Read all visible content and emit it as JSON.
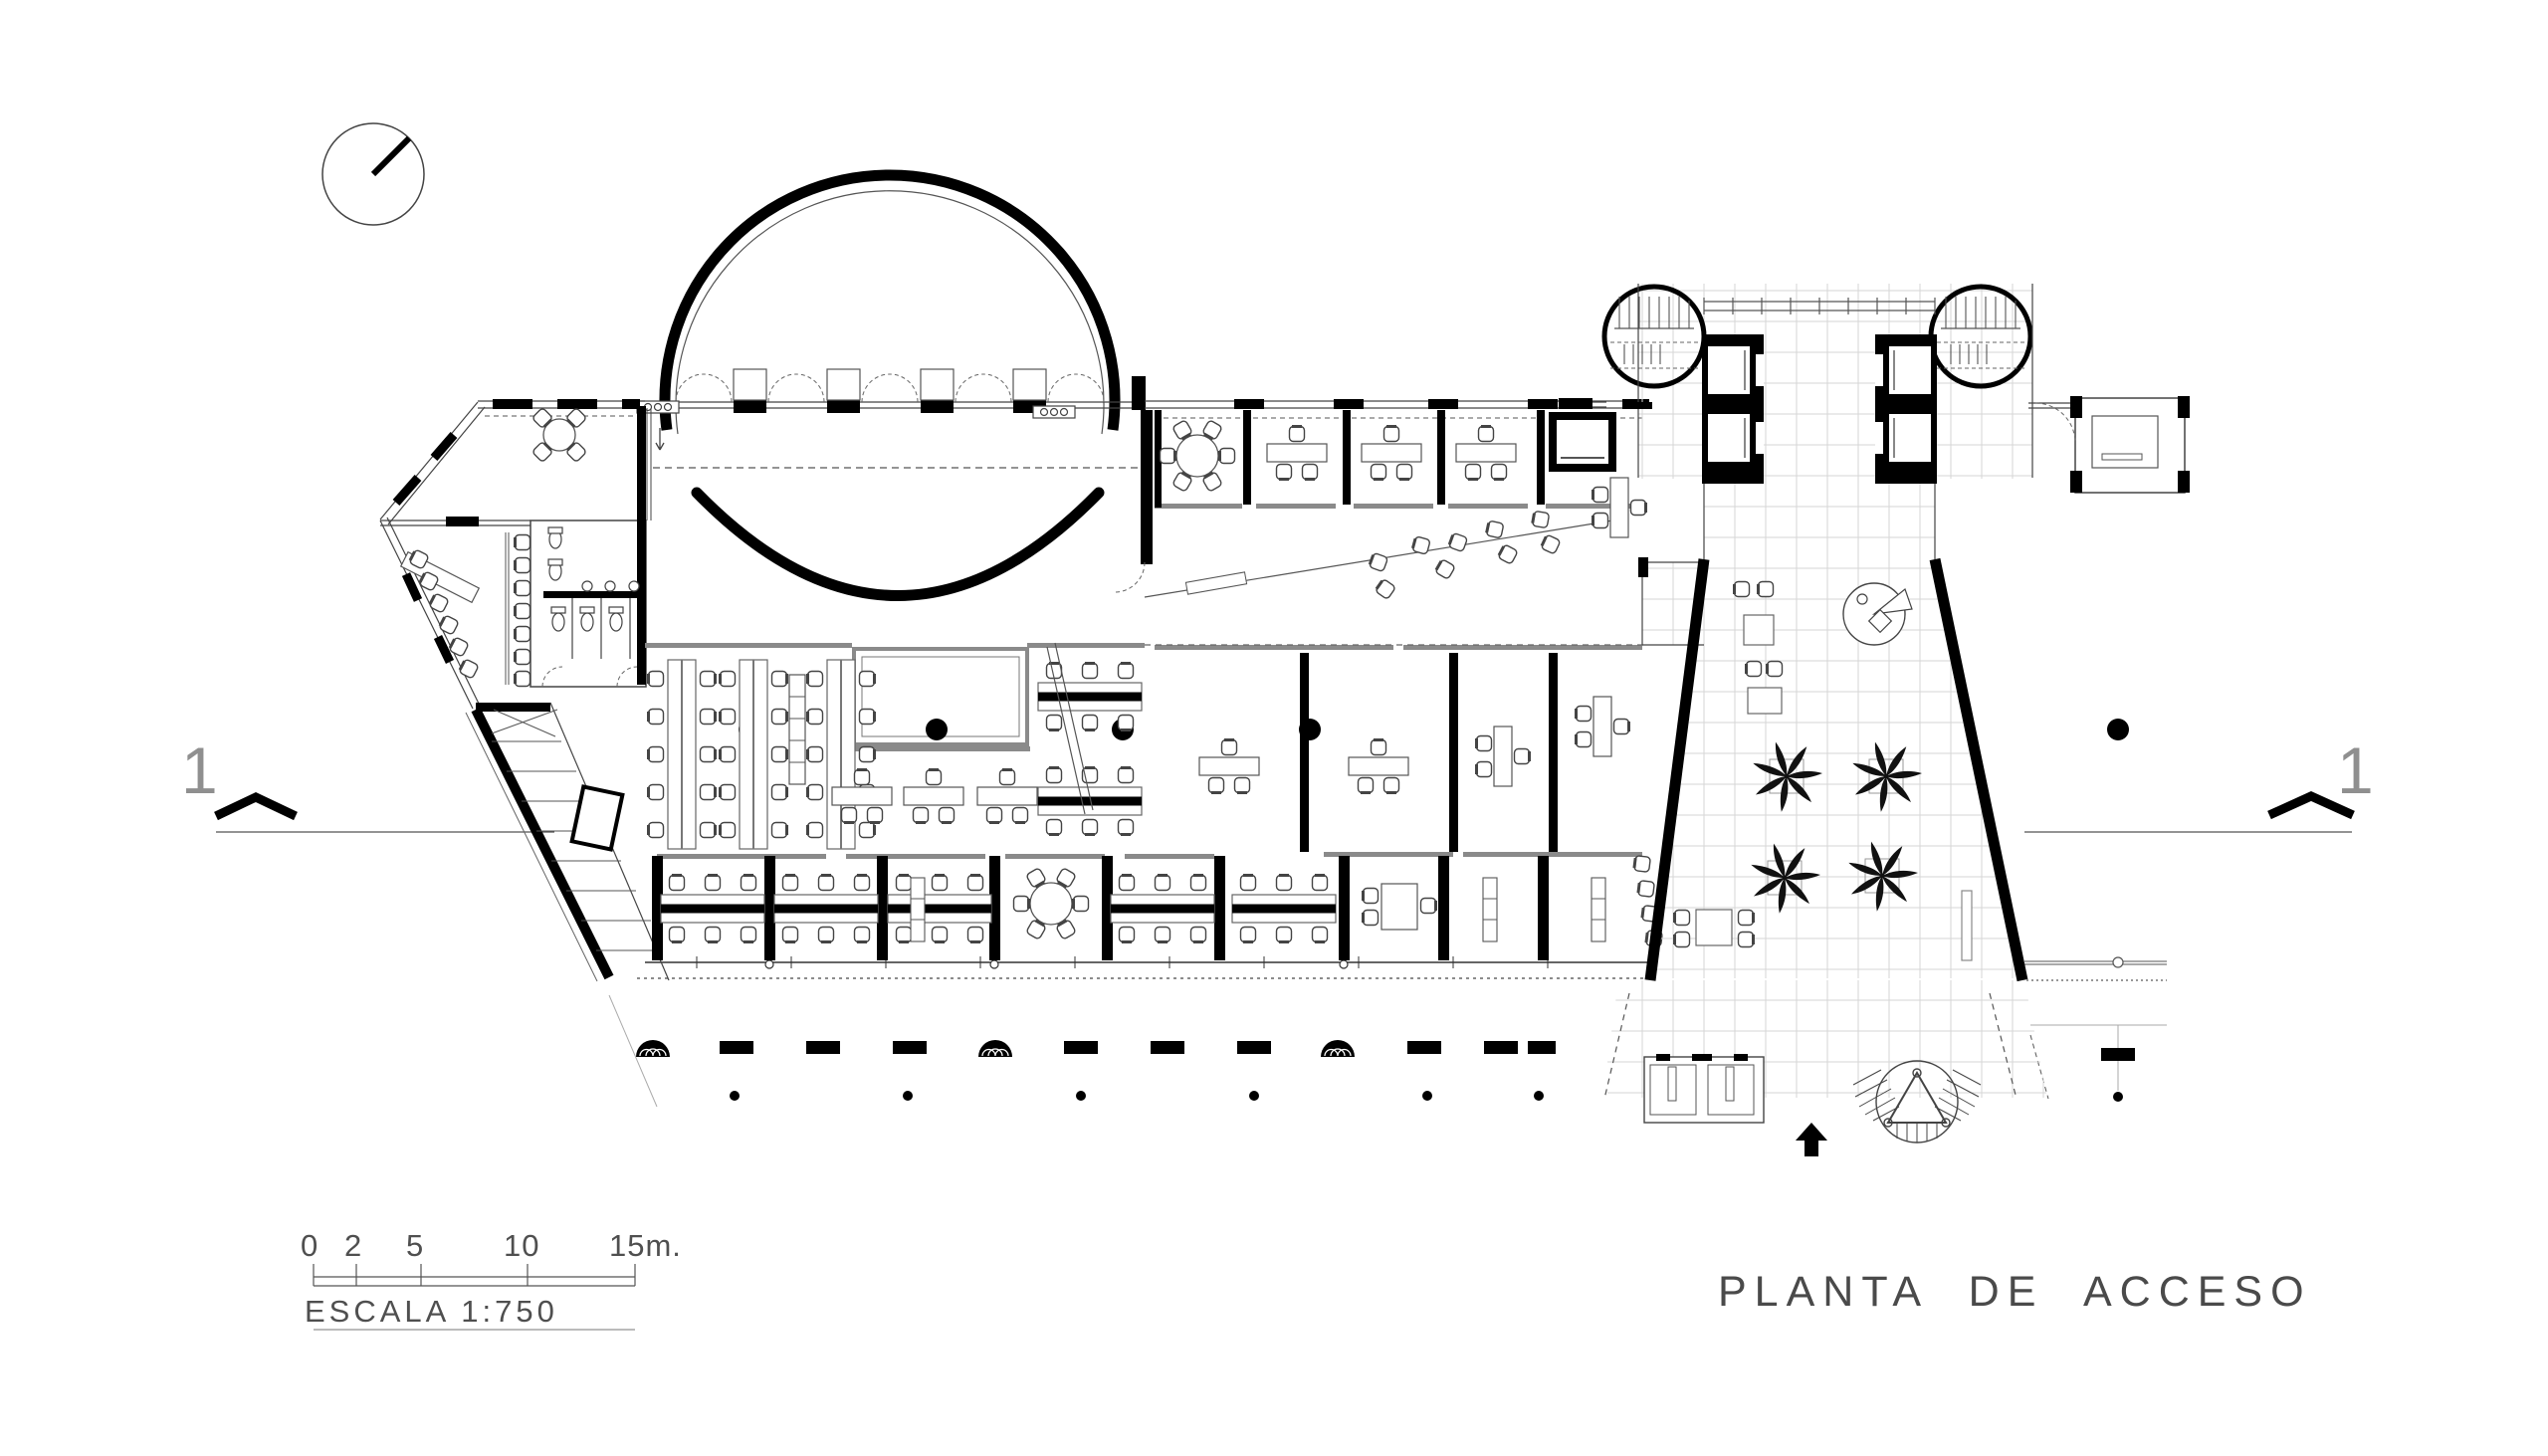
{
  "drawing": {
    "title": "PLANTA DE ACCESO",
    "scale_bar": {
      "tick_labels": [
        "0",
        "2",
        "5",
        "10",
        "15m."
      ],
      "scale_label": "ESCALA 1:750"
    },
    "section_marker_left": "1",
    "section_marker_right": "1",
    "colors": {
      "wall_black": "#0a0a0a",
      "line_ink": "#3a3a3a",
      "gray_partition": "#8a8a8a",
      "tile_grid": "#d6d6d6",
      "annotation_text": "#4f4f4f"
    },
    "icons": {
      "north_indicator": "compass-needle-circle",
      "section_cut": "bold-chevron-up",
      "entrance_arrow": "solid-arrow-up",
      "palm_tree": "palm-plan-symbol",
      "stair_tower": "round-stair-plan-symbol"
    }
  }
}
